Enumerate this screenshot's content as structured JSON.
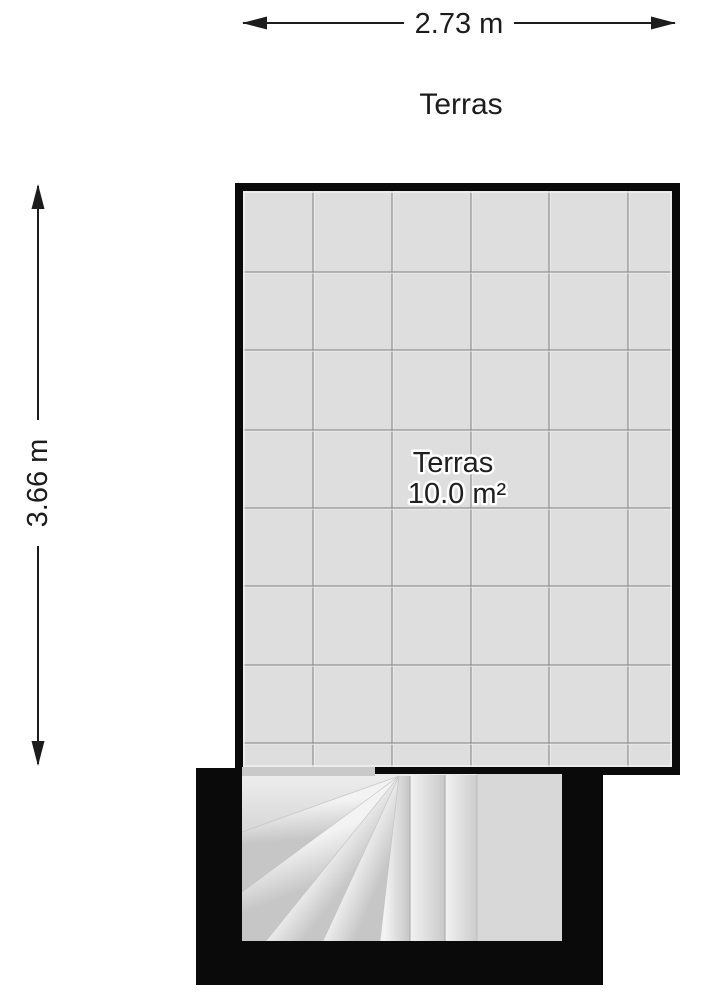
{
  "plan": {
    "floor_title": "Terras",
    "width_dimension": "2.73 m",
    "height_dimension": "3.66 m",
    "room": {
      "name": "Terras",
      "area": "10.0 m²"
    }
  },
  "colors": {
    "wall": "#0a0a0a",
    "floor": "#dedede",
    "grid_line": "#808080",
    "grid_bevel": "#ededed",
    "stair_base": "#eaeaea",
    "stair_landing": "#d8d8d8",
    "threshold": "#c9c9c9",
    "dimension_ink": "#1c1c1c",
    "background": "#ffffff"
  }
}
